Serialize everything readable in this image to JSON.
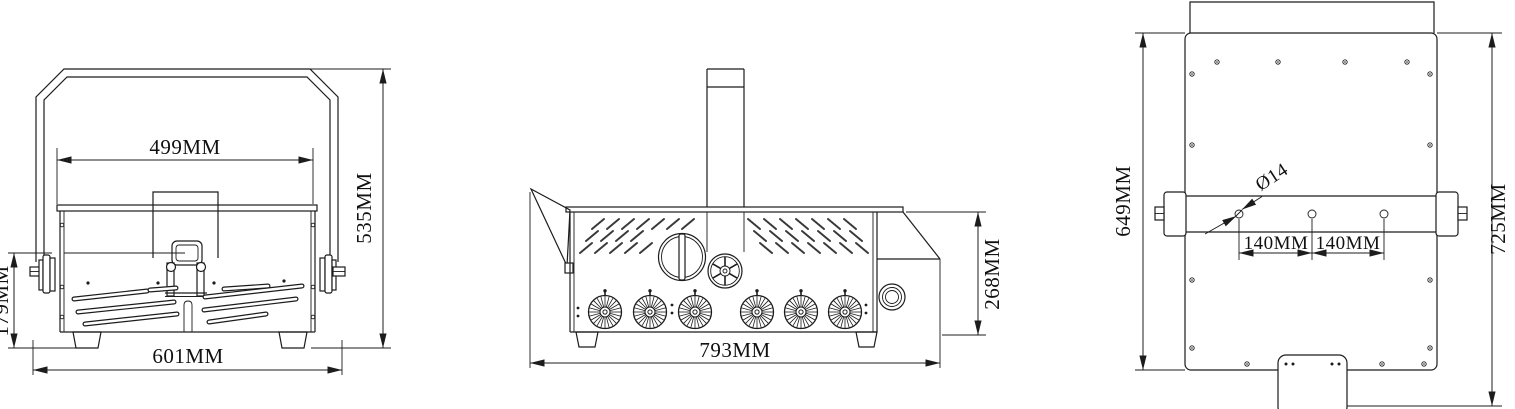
{
  "drawing": {
    "background": "#ffffff",
    "line_color": "#1c1c1c",
    "front_view": {
      "dim_cover_width": "499MM",
      "dim_overall_height": "535MM",
      "dim_lower_height": "179MM",
      "dim_overall_width": "601MM"
    },
    "side_view": {
      "dim_overall_length": "793MM",
      "dim_body_height": "268MM"
    },
    "top_view": {
      "dim_panel_length": "649MM",
      "dim_overall_length": "725MM",
      "hole_diameter": "Ø14",
      "hole_spacing_left": "140MM",
      "hole_spacing_right": "140MM"
    }
  }
}
